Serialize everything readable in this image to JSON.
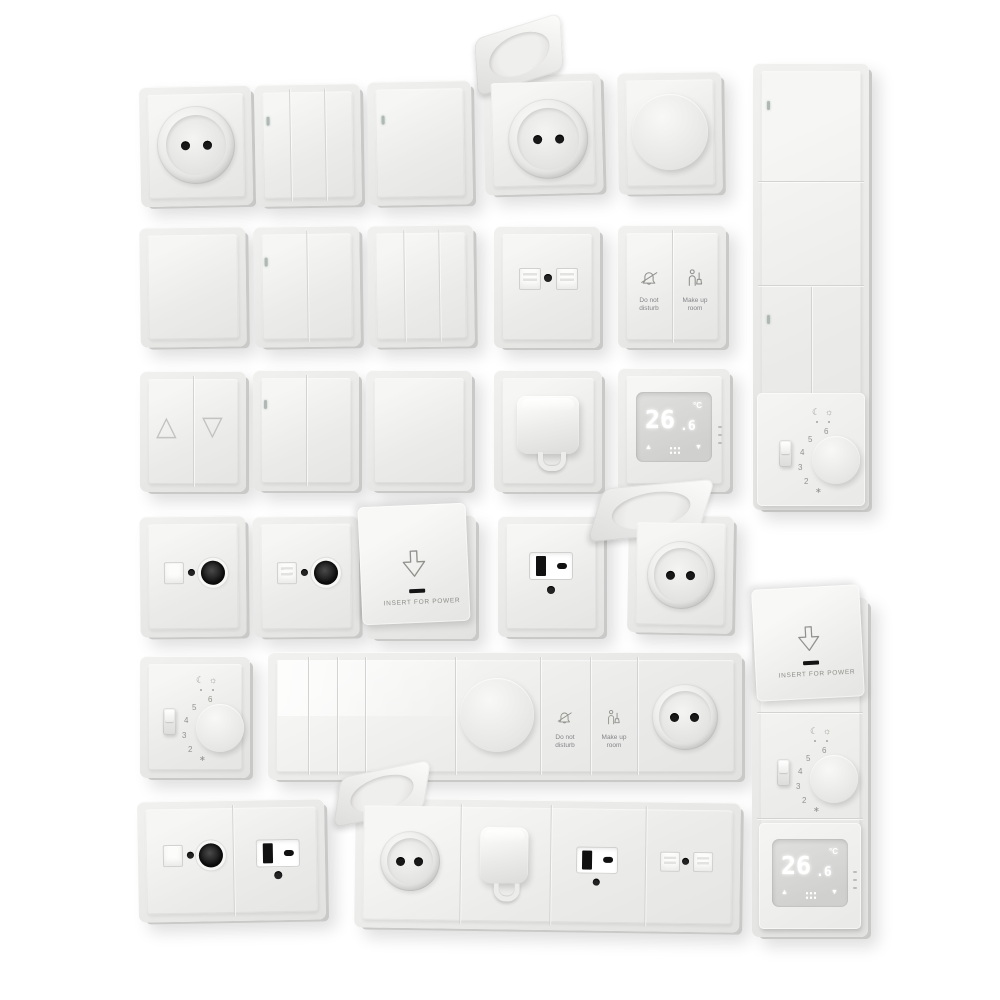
{
  "image": {
    "description": "3D render catalogue of white electrical wall fittings: switches, sockets, dimmers, thermostats, hotel controls",
    "background": "#ffffff"
  },
  "colors": {
    "plate": "#ececea",
    "plate_edge": "#c9c9c7",
    "face_highlight": "#f6f6f4",
    "hole_black": "#181818",
    "icon_gray": "#90908c",
    "screen": "#d6d6d4",
    "digit_white": "#ffffff",
    "led": "#aeb8b4"
  },
  "labels": {
    "do_not_disturb": [
      "Do not",
      "disturb"
    ],
    "make_up_room": [
      "Make up",
      "room"
    ],
    "insert_for_power": "INSERT FOR POWER",
    "temp_integer": "26",
    "temp_decimal": ".6",
    "temp_unit": "°C",
    "dial": [
      "2",
      "3",
      "4",
      "5",
      "6"
    ],
    "frost": "∗",
    "moon": "☾",
    "sun": "☼",
    "up_triangle": "△",
    "down_triangle": "▽",
    "arrow_up": "▲",
    "arrow_down": "▼"
  },
  "items": [
    {
      "name": "schuko-socket",
      "row": 1
    },
    {
      "name": "three-gang-switch-led",
      "row": 1
    },
    {
      "name": "one-gang-switch-led",
      "row": 1
    },
    {
      "name": "schuko-socket-open-lid",
      "row": 1
    },
    {
      "name": "rotary-dimmer",
      "row": 1
    },
    {
      "name": "vertical-combo-panel-switches-and-dial-thermostat",
      "row": 1
    },
    {
      "name": "one-gang-switch-plain",
      "row": 2
    },
    {
      "name": "two-gang-switch-led",
      "row": 2
    },
    {
      "name": "three-gang-switch",
      "row": 2
    },
    {
      "name": "dual-data-socket",
      "row": 2
    },
    {
      "name": "hotel-service-switch-dnd-mur",
      "row": 2
    },
    {
      "name": "blind-shutter-switch",
      "row": 3
    },
    {
      "name": "two-gang-switch-led",
      "row": 3
    },
    {
      "name": "one-gang-switch-plain",
      "row": 3
    },
    {
      "name": "hooded-cable-outlet",
      "row": 3
    },
    {
      "name": "digital-thermostat",
      "row": 3
    },
    {
      "name": "tv-coax-socket",
      "row": 4
    },
    {
      "name": "tv-coax-socket-variant",
      "row": 4
    },
    {
      "name": "key-card-power-holder",
      "row": 4
    },
    {
      "name": "usb-a-c-outlet",
      "row": 4
    },
    {
      "name": "schuko-socket-open-lid-large",
      "row": 4
    },
    {
      "name": "dial-thermostat",
      "row": 5
    },
    {
      "name": "horizontal-combo-panel-switches-dimmer-dnd-mur-socket",
      "row": 5
    },
    {
      "name": "combo-plate-tv-and-usb",
      "row": 6
    },
    {
      "name": "horizontal-combo-panel-socket-hood-usb-data",
      "row": 6
    },
    {
      "name": "vertical-combo-panel-keycard-dial-digital-thermostat",
      "row": 6
    }
  ]
}
